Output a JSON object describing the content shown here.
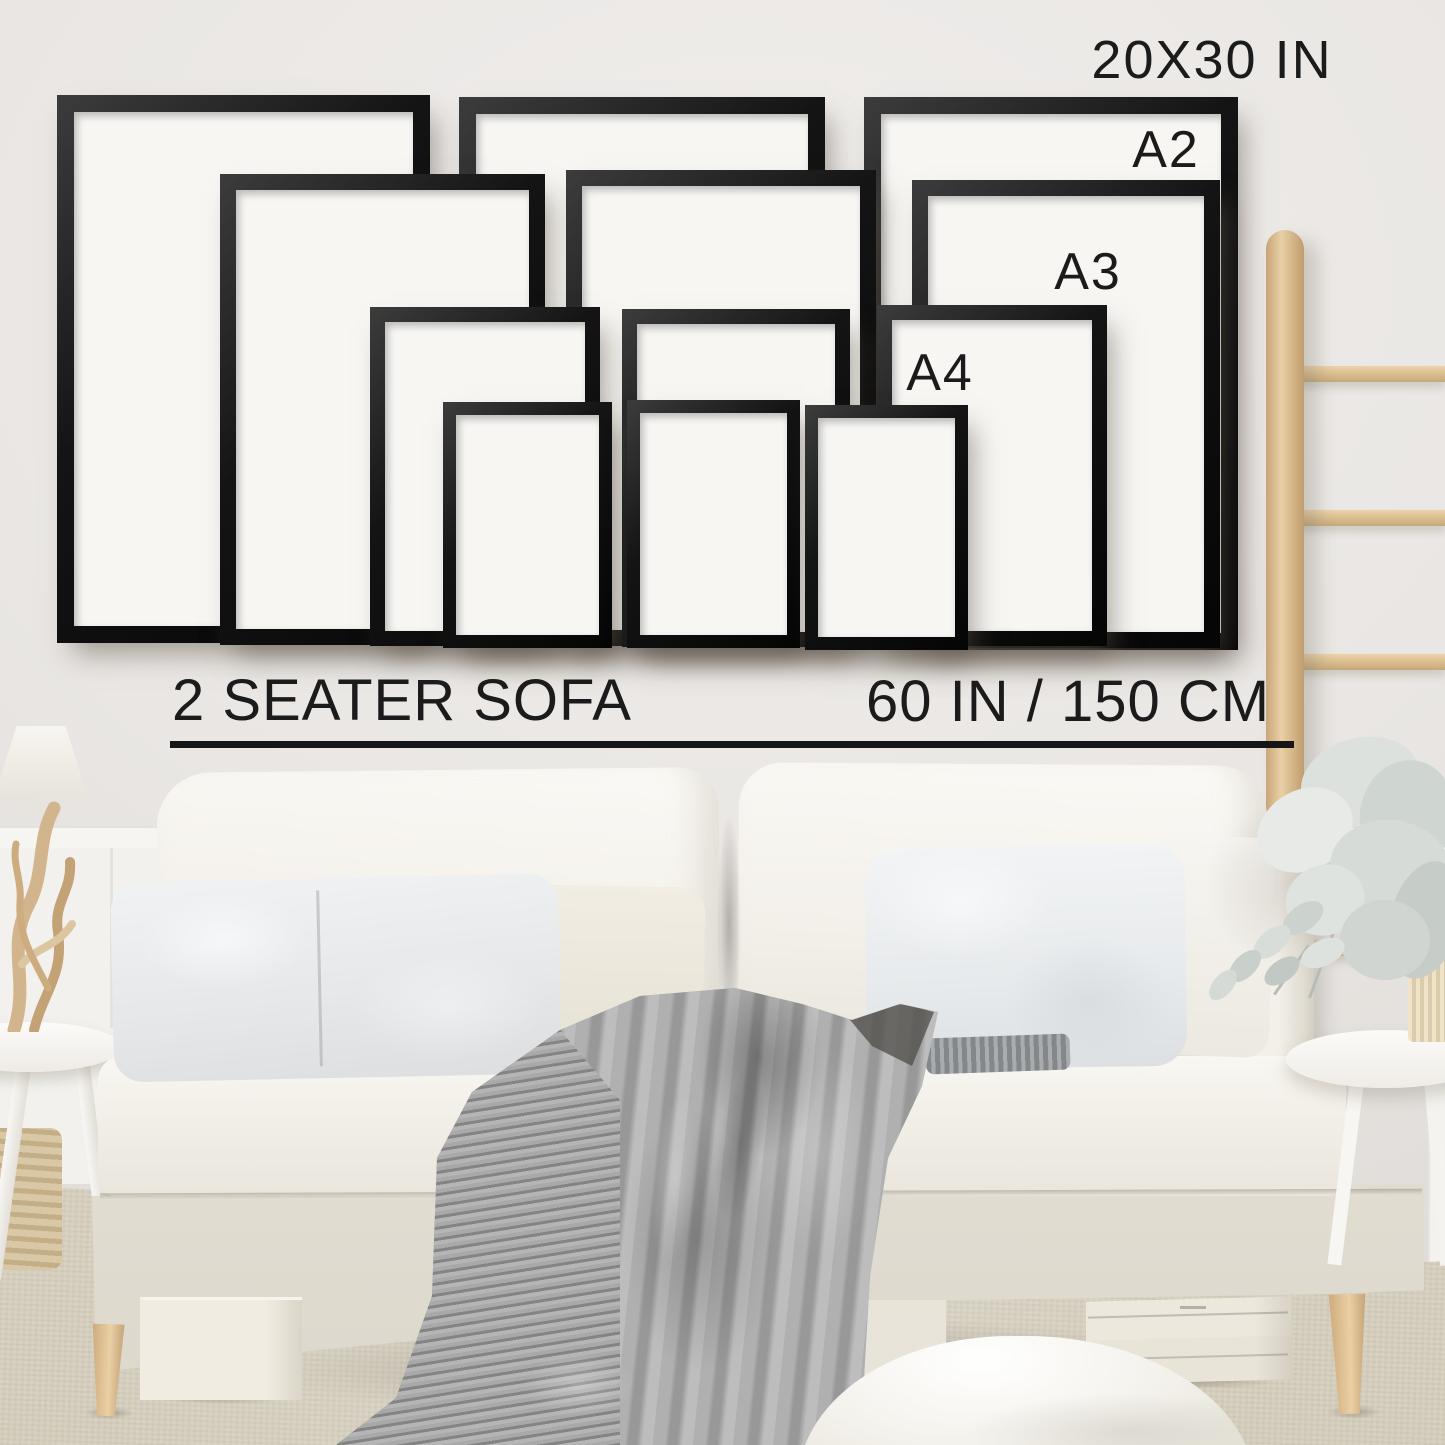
{
  "scene": {
    "type": "poster-frame size guide photo over sofa",
    "labels": {
      "largest": "20X30 IN",
      "a2": "A2",
      "a3": "A3",
      "a4": "A4"
    },
    "caption": {
      "sofa": "2 SEATER SOFA",
      "width": "60 IN / 150 CM"
    },
    "frames": {
      "sizes": [
        "20X30 IN",
        "A2",
        "A3",
        "A4"
      ],
      "count_per_size": 3
    }
  },
  "colors": {
    "wall": "#e9e6e3",
    "frame_black": "#141414",
    "mat_white": "#f7f6f3",
    "text": "#1b1b1b",
    "sofa_cream": "#f2efe8",
    "blanket_gray": "#9d9d9d",
    "wood_tan": "#d9ba8c",
    "carpet_beige": "#d9d2c3"
  }
}
